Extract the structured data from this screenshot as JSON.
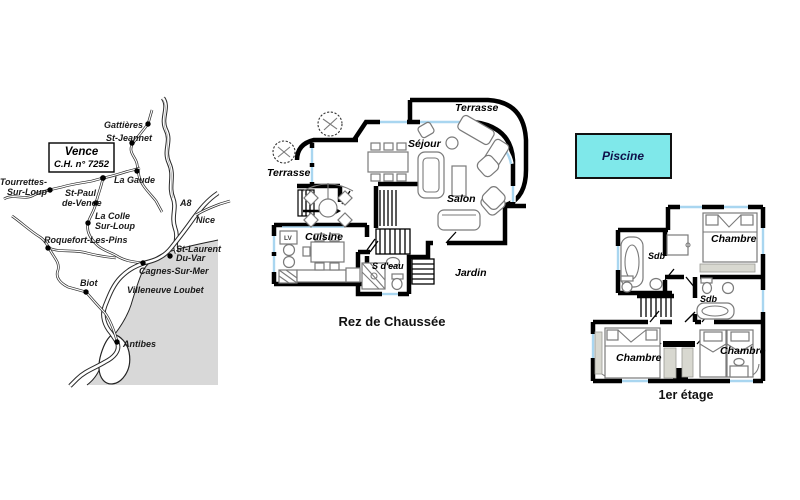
{
  "colors": {
    "wall": "#000000",
    "window_glass": "#a9d6f0",
    "sea_grey": "#d8d8d8",
    "pool_fill": "#7fe8ea",
    "pool_text": "#101049",
    "furniture_outline": "#7a7a7a"
  },
  "map": {
    "box": {
      "title": "Vence",
      "reference": "C.H. n° 7252"
    },
    "towns": {
      "gattieres": "Gattières",
      "st_jeannet": "St-Jeannet",
      "la_gaude": "La Gaude",
      "tourrettes_l1": "Tourrettes-",
      "tourrettes_l2": "Sur-Loup",
      "st_paul_l1": "St-Paul",
      "st_paul_l2": "de-Vence",
      "la_colle_l1": "La Colle",
      "la_colle_l2": "Sur-Loup",
      "roquefort": "Roquefort-Les-Pins",
      "st_laurent_l1": "St-Laurent",
      "st_laurent_l2": "Du-Var",
      "cagnes": "Cagnes-Sur-Mer",
      "biot": "Biot",
      "villeneuve": "Villeneuve Loubet",
      "antibes": "Antibes",
      "nice": "Nice",
      "a8": "A8"
    }
  },
  "ground_floor": {
    "caption": "Rez de Chaussée",
    "rooms": {
      "terrasse_top": "Terrasse",
      "terrasse_left": "Terrasse",
      "sejour": "Séjour",
      "salon": "Salon",
      "cuisine": "Cuisine",
      "s_deau": "S d'eau",
      "jardin": "Jardin"
    },
    "appliance_lv": "LV"
  },
  "first_floor": {
    "caption": "1er étage",
    "rooms": {
      "chambre_top": "Chambre",
      "sdb_top": "Sdb",
      "sdb_mid": "Sdb",
      "chambre_left": "Chambre",
      "chambre_right": "Chambre"
    }
  },
  "pool": {
    "label": "Piscine"
  }
}
